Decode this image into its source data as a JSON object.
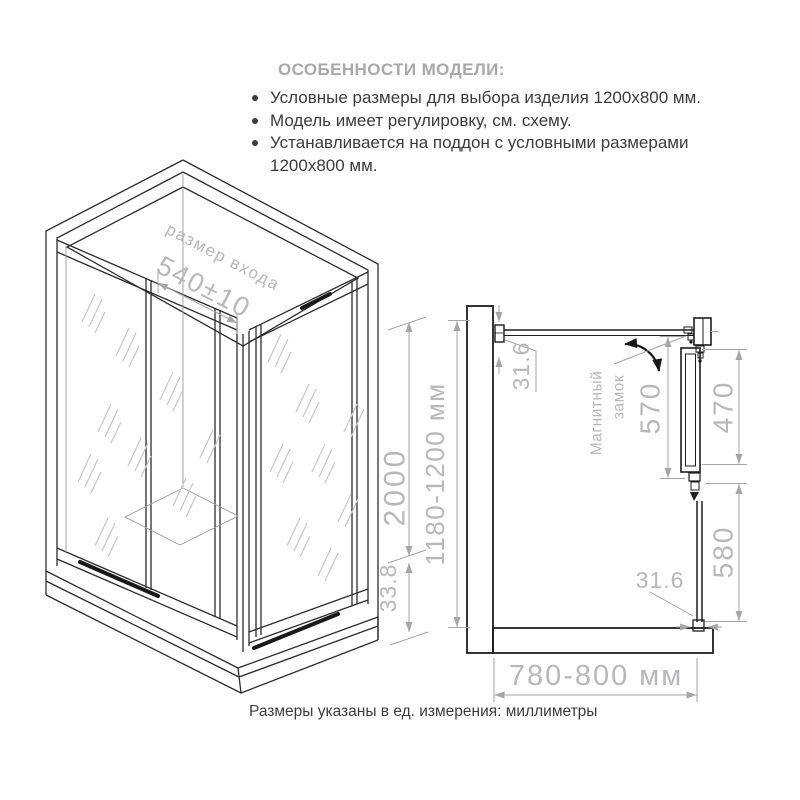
{
  "header": {
    "title": "ОСОБЕННОСТИ МОДЕЛИ:",
    "bullets": [
      "Условные размеры для выбора изделия 1200х800 мм.",
      "Модель имеет регулировку, см. схему.",
      "Устанавливается на поддон с условными размерами 1200х800 мм."
    ]
  },
  "iso_view": {
    "entrance_label": "размер входа",
    "entrance_dim": "540±10",
    "height_dim": "2000",
    "tray_height_dim": "33.8"
  },
  "plan_view": {
    "depth_dim": "1180-1200 мм",
    "width_dim": "780-800 мм",
    "top_profile_dim": "31.6",
    "bottom_profile_dim": "31.6",
    "door_opening_dim": "570",
    "door_leaf_dim": "470",
    "fixed_panel_dim": "580",
    "lock_label_line1": "Магнитный",
    "lock_label_line2": "замок"
  },
  "footer": {
    "note": "Размеры указаны в ед. измерения: миллиметры"
  },
  "colors": {
    "line_dark": "#2c2c30",
    "dim_gray": "#a5a5ab",
    "dim_text": "#b7b7bc",
    "title_gray": "#a7a7ad",
    "body_text": "#3b3b41"
  }
}
